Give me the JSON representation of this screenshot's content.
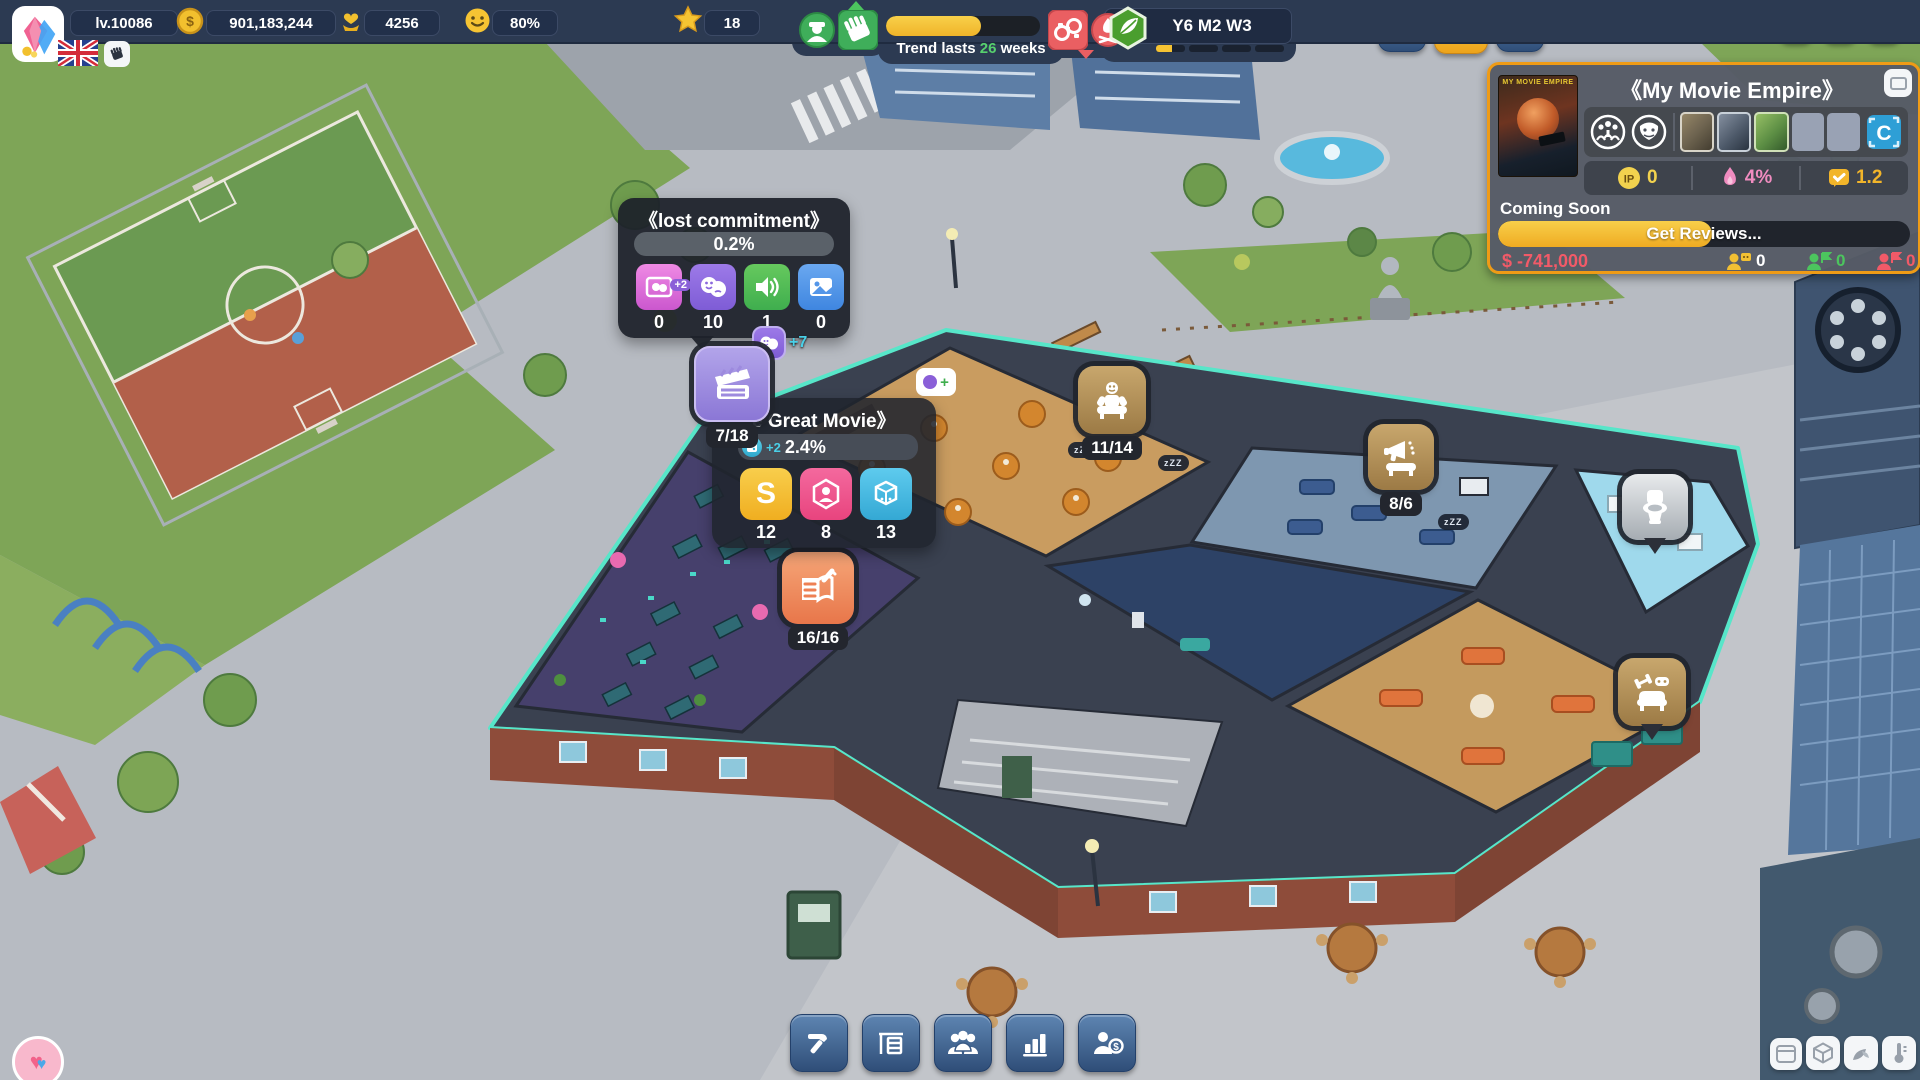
{
  "topbar": {
    "level": "lv.10086",
    "money": "901,183,244",
    "fans": "4256",
    "happiness": "80%",
    "stars": "18",
    "trend_prefix": "Trend lasts",
    "trend_weeks": "26",
    "trend_suffix": "weeks",
    "date": "Y6 M2 W3"
  },
  "progress": {
    "trend_pct": 62,
    "week_pct": 55,
    "reviews_pct": 52
  },
  "movie_panel": {
    "title": "《My Movie Empire》",
    "poster_title": "MY MOVIE EMPIRE",
    "ip_label": "IP",
    "ip_value": "0",
    "popularity": "4%",
    "review_score": "1.2",
    "status": "Coming Soon",
    "progress_label": "Get Reviews...",
    "budget": "$ -741,000",
    "viewers_yellow": "0",
    "viewers_green": "0",
    "viewers_red": "0",
    "c_badge": "C"
  },
  "tooltip_lost": {
    "title": "《lost commitment》",
    "percent": "0.2%",
    "stat_badge": "+2",
    "stats": [
      {
        "name": "scene-masks",
        "value": "0"
      },
      {
        "name": "drama-masks",
        "value": "10"
      },
      {
        "name": "audio",
        "value": "1"
      },
      {
        "name": "image",
        "value": "0"
      }
    ]
  },
  "tooltip_movie": {
    "title": "e Great Movie》",
    "percent": "2.4%",
    "badge": "+2",
    "stats": [
      {
        "name": "script",
        "value": "12"
      },
      {
        "name": "cast",
        "value": "8"
      },
      {
        "name": "studio",
        "value": "13"
      }
    ]
  },
  "floating_badge": "+7",
  "rooms": {
    "production": "7/18",
    "canteen": "11/14",
    "marketing": "8/6",
    "writing": "16/16"
  },
  "sleep_badge": "zZZ"
}
